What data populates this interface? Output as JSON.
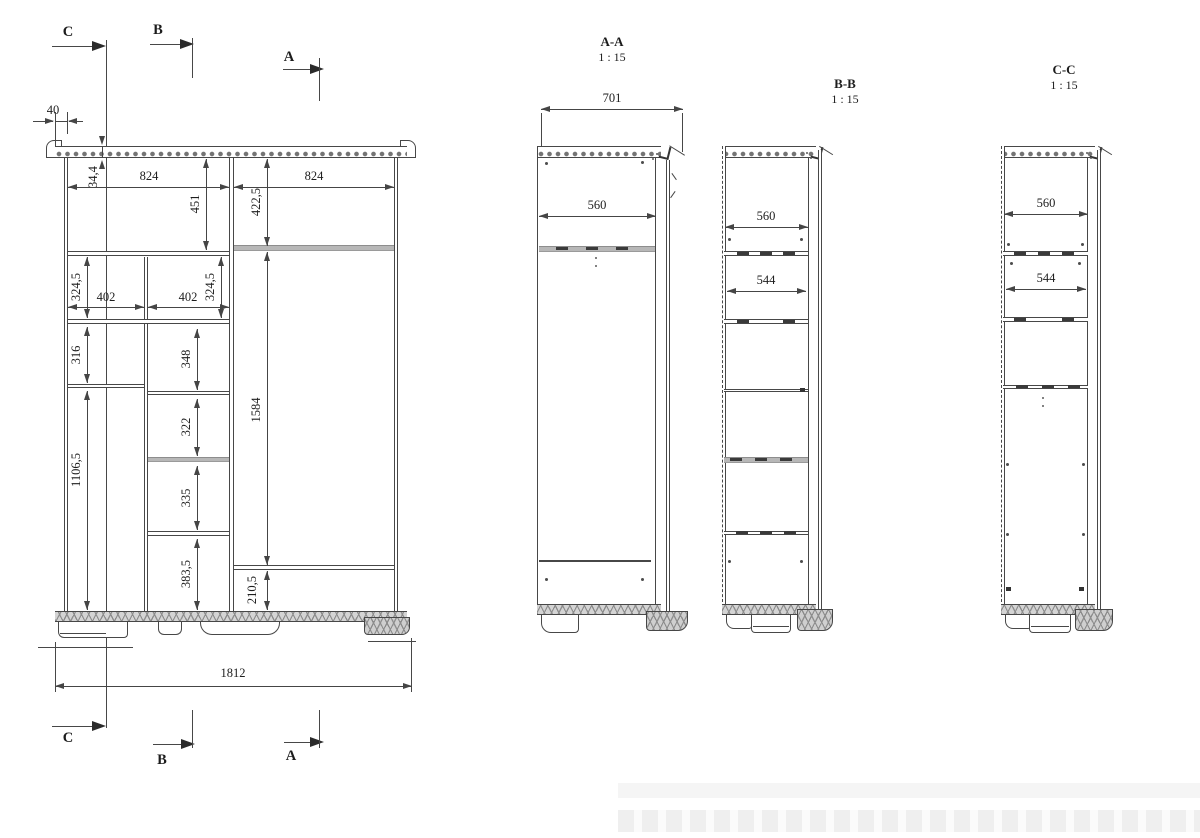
{
  "front_view": {
    "markers": {
      "a": "A",
      "b": "B",
      "c": "C"
    },
    "dims": {
      "overhang": "40",
      "top_panel": "34,4",
      "bay_left_width": "824",
      "bay_right_width": "824",
      "top_left_height": "451",
      "top_right_height": "422,5",
      "left_box_height": "324,5",
      "mid_box_height": "324,5",
      "left_box_width": "402",
      "mid_box_width": "402",
      "left_shelf_height": "316",
      "mid_shelf1_height": "348",
      "mid_shelf2_height": "322",
      "mid_shelf3_height": "335",
      "mid_shelf4_height": "383,5",
      "left_tall_height": "1106,5",
      "right_tall_height": "1584",
      "right_bottom_height": "210,5",
      "overall_width": "1812"
    }
  },
  "section_aa": {
    "title": "A-A",
    "scale": "1 : 15",
    "depth": "701",
    "shelf_width": "560"
  },
  "section_bb": {
    "title": "B-B",
    "scale": "1 : 15",
    "shelf_width": "560",
    "drawer_width": "544"
  },
  "section_cc": {
    "title": "C-C",
    "scale": "1 : 15",
    "shelf_width": "560",
    "drawer_width": "544"
  }
}
